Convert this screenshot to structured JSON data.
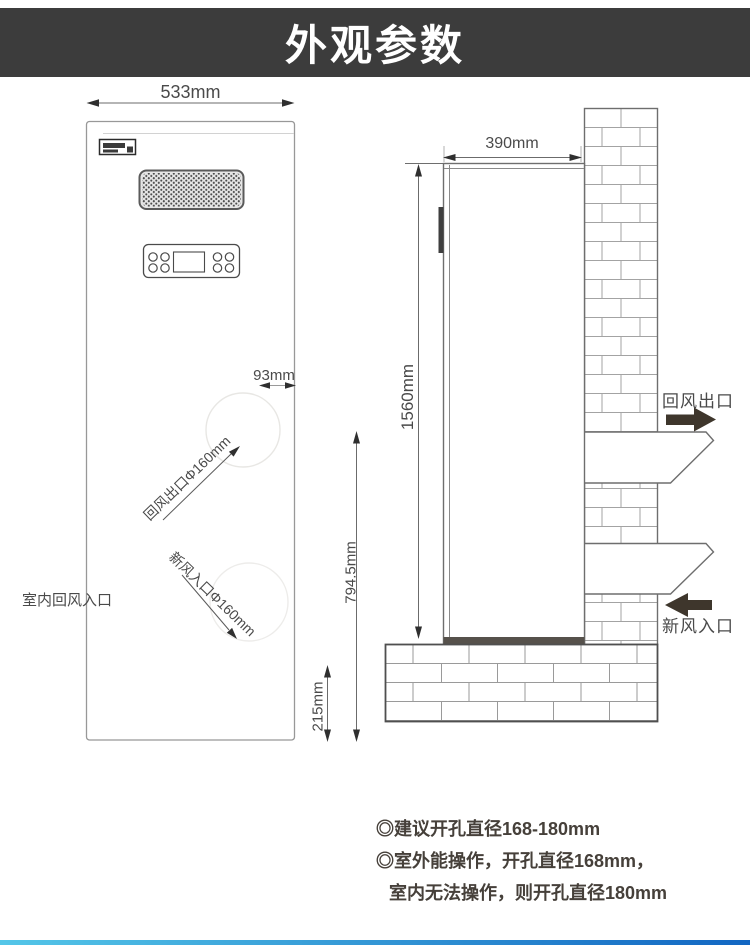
{
  "header": {
    "title": "外观参数"
  },
  "front_view": {
    "width_dim": "533mm",
    "port_offset_dim": "93mm",
    "return_outlet_port_label": "回风出口Φ160mm",
    "fresh_inlet_port_label": "新风入口Φ160mm",
    "indoor_return_inlet_label": "室内回风入口",
    "base_height_dim": "215mm"
  },
  "side_view": {
    "depth_dim": "390mm",
    "height_dim": "1560mm",
    "inlet_center_height_dim": "794.5mm",
    "return_air_outlet_label": "回风出口",
    "fresh_air_inlet_label": "新风入口"
  },
  "notes": {
    "line1": "◎建议开孔直径168-180mm",
    "line2": "◎室外能操作，开孔直径168mm，",
    "line3": "室内无法操作，则开孔直径180mm"
  },
  "colors": {
    "header-bg": "#3c3c3c",
    "header-text": "#ffffff",
    "dim-text": "#4a4a4a",
    "note-text": "#46403a",
    "arrow-fill": "#3e362c",
    "bar-left": "#54c6e8",
    "bar-right": "#1266c2"
  }
}
